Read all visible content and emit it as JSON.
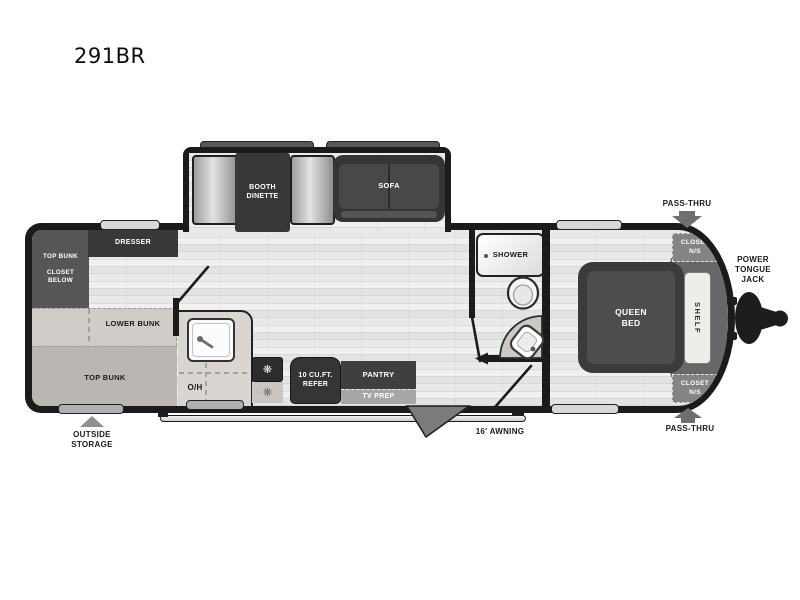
{
  "model": "291BR",
  "colors": {
    "wall": "#1b1b1b",
    "floor_light": "#e9e9e9",
    "dark_furniture": "#3a3a3a",
    "medium_gray": "#6f6f6f",
    "counter": "#d9d6d1",
    "bunk_light": "#cfccc7",
    "bunk_medium": "#bab7b2",
    "fixture_white": "#f7f7f7"
  },
  "slideout": {
    "dinette_label": "BOOTH\nDINETTE",
    "sofa_label": "SOFA"
  },
  "bunk_room": {
    "bunk_closet_label": "TOP BUNK\n\nCLOSET\nBELOW",
    "dresser_label": "DRESSER",
    "lower_bunk_label": "LOWER BUNK",
    "top_bunk_label": "TOP BUNK"
  },
  "kitchen": {
    "overhead_label": "O/H",
    "burner_icon": "❋",
    "refer_label": "10 CU.FT.\nREFER",
    "pantry_label": "PANTRY",
    "tv_prep_label": "TV PREP"
  },
  "bathroom": {
    "shower_label": "SHOWER"
  },
  "bedroom": {
    "queen_bed_label": "QUEEN\nBED",
    "shelf_label": "SHELF",
    "closet_top_label": "CLOSET\nN/S",
    "closet_bottom_label": "CLOSET\nN/S"
  },
  "exterior": {
    "pass_thru_top_label": "PASS-THRU",
    "pass_thru_bottom_label": "PASS-THRU",
    "power_tongue_jack_label": "POWER\nTONGUE\nJACK",
    "outside_storage_label": "OUTSIDE\nSTORAGE",
    "awning_label": "16' AWNING"
  }
}
